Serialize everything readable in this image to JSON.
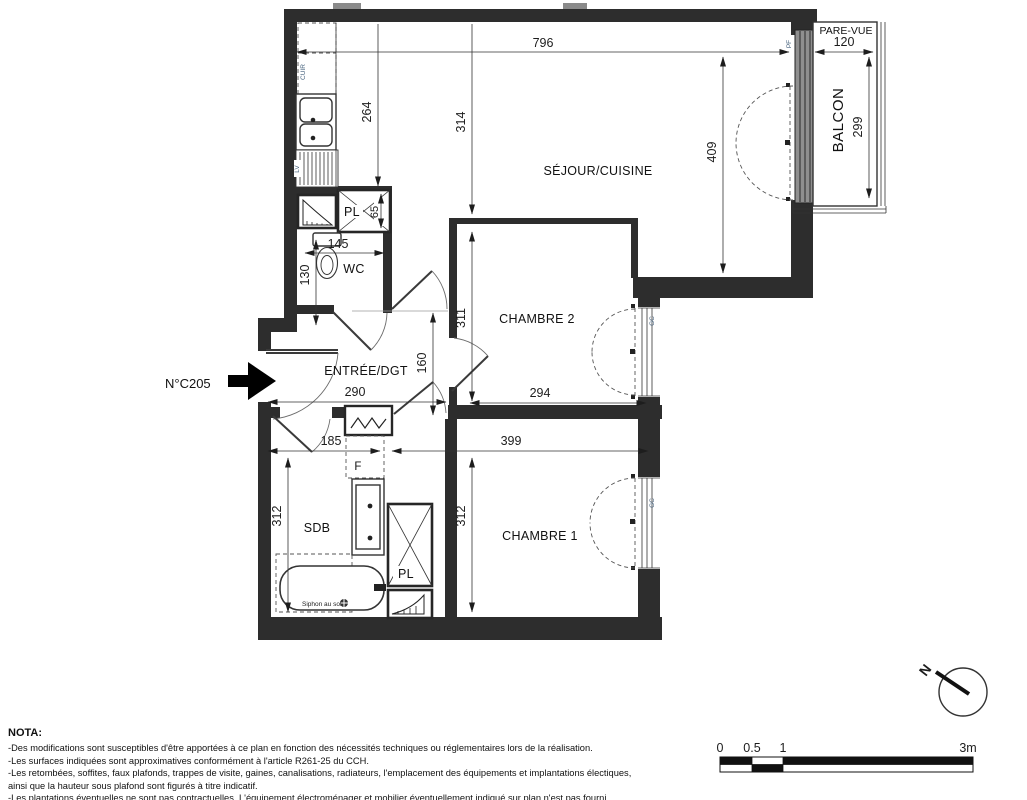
{
  "plan": {
    "unit_label": "N°C205",
    "rooms": {
      "sejour": "SÉJOUR/CUISINE",
      "chambre2": "CHAMBRE 2",
      "chambre1": "CHAMBRE 1",
      "entree": "ENTRÉE/DGT",
      "wc": "WC",
      "sdb": "SDB",
      "balcon": "BALCON",
      "pare_vue": "PARE-VUE"
    },
    "fixtures": {
      "pl_upper": "PL",
      "pl_lower": "PL",
      "f": "F",
      "cuir": "CUIR",
      "lv": "LV",
      "siphon": "Siphon au sol",
      "gc_ch2": "GC",
      "gc_ch1": "GC",
      "pf": "PF"
    },
    "dims": {
      "w_sejour": "796",
      "kitchen_depth": "264",
      "sejour_left": "314",
      "sejour_right": "409",
      "balcon_w": "120",
      "balcon_h": "299",
      "wc_w": "145",
      "wc_h": "130",
      "ch2_h": "311",
      "ch2_w": "294",
      "hall_h": "160",
      "entree_w": "290",
      "sdb_w": "185",
      "ch1_w": "399",
      "sdb_h": "312",
      "ch1_h": "312",
      "pl_h": "65"
    }
  },
  "nota": {
    "title": "NOTA:",
    "lines": [
      "-Des modifications sont susceptibles d'être apportées à ce plan en fonction des nécessités techniques ou réglementaires lors de la réalisation.",
      "-Les surfaces indiquées sont approximatives conformément à l'article R261-25 du CCH.",
      "-Les retombées, soffites, faux plafonds, trappes de visite, gaines, canalisations, radiateurs, l'emplacement des équipements et implantations électiques,",
      "ainsi que la hauteur sous plafond sont figurés à titre indicatif.",
      "-Les plantations éventuelles ne sont pas contractuelles. L'équipement électroménager et mobilier éventuellement indiqué sur plan n'est pas fourni."
    ]
  },
  "scale_bar": {
    "t0": "0",
    "t05": "0.5",
    "t1": "1",
    "t3": "3m"
  },
  "compass": {
    "north": "N"
  }
}
